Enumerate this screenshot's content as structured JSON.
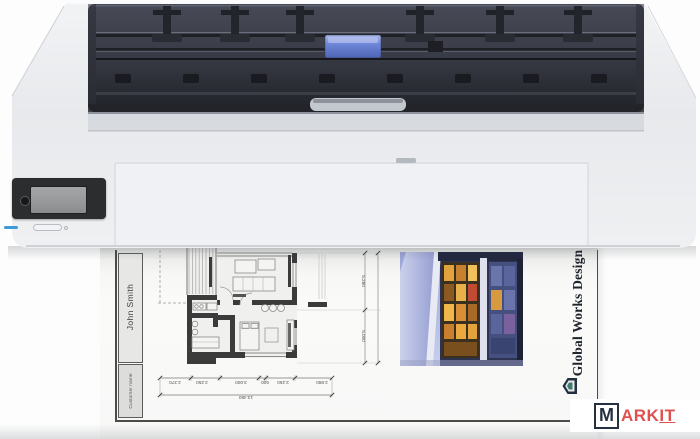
{
  "watermark": {
    "m": "M",
    "ark": "ARK",
    "it": "IT"
  },
  "document": {
    "customer_label": "Customer name",
    "customer_name": "John Smith",
    "company_name": "Global Works Design",
    "floorplan": {
      "dims_horizontal": [
        "2.370",
        "2.250",
        "3.000",
        "500",
        "2.250",
        "2.880"
      ],
      "dim_total": "13.450",
      "dims_vertical": [
        "5.280",
        "5.000"
      ]
    }
  },
  "colors": {
    "watermark_red": "#df5150",
    "watermark_navy": "#243140",
    "company_logo_teal": "#3e7d6d",
    "carriage_blue": "#6e86d8",
    "status_led_blue": "#3f9ad8"
  }
}
